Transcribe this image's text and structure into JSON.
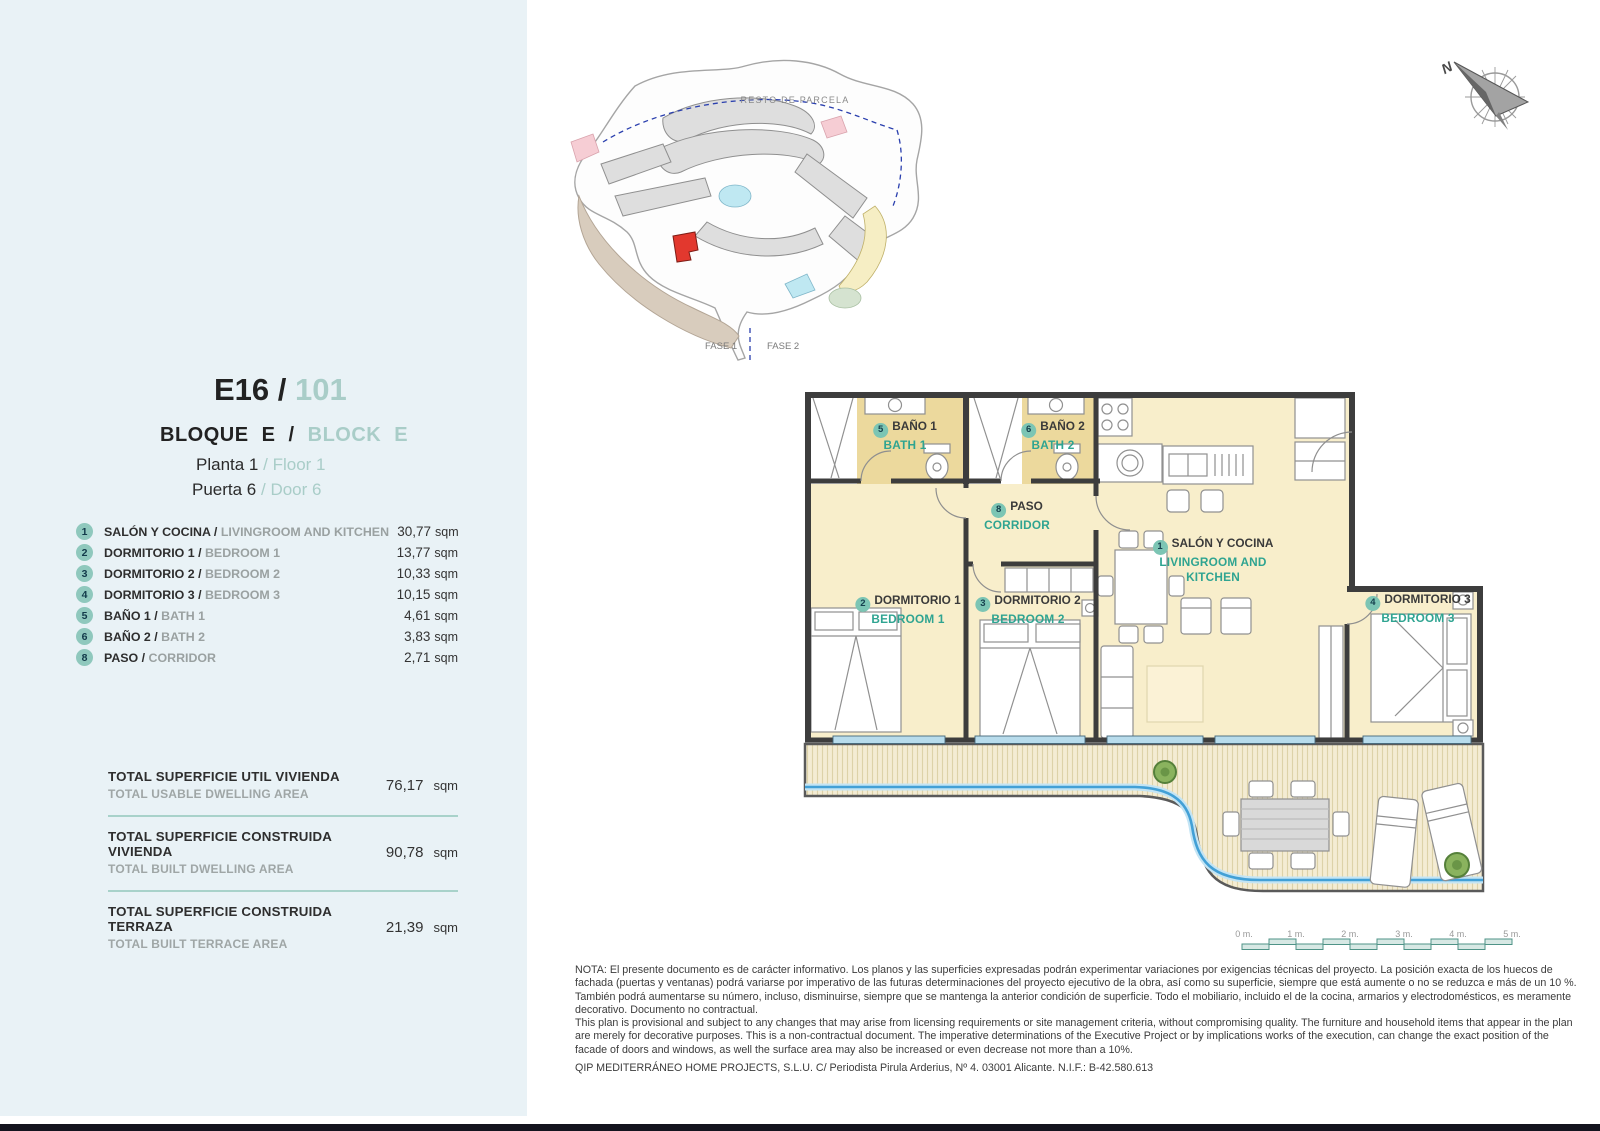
{
  "header": {
    "code": "E16",
    "slash": "/",
    "unit": "101",
    "bloque": "BLOQUE E",
    "block": "BLOCK E",
    "planta_label": "Planta 1",
    "floor_label": "Floor 1",
    "puerta_label": "Puerta 6",
    "door_label": "Door 6"
  },
  "rooms": [
    {
      "num": "1",
      "es": "SALÓN Y COCINA /",
      "en": "LIVINGROOM AND KITCHEN",
      "area": "30,77",
      "unit": "sqm"
    },
    {
      "num": "2",
      "es": "DORMITORIO 1 /",
      "en": "BEDROOM 1",
      "area": "13,77",
      "unit": "sqm"
    },
    {
      "num": "3",
      "es": "DORMITORIO 2 /",
      "en": "BEDROOM 2",
      "area": "10,33",
      "unit": "sqm"
    },
    {
      "num": "4",
      "es": "DORMITORIO 3 /",
      "en": "BEDROOM 3",
      "area": "10,15",
      "unit": "sqm"
    },
    {
      "num": "5",
      "es": "BAÑO 1 /",
      "en": "BATH 1",
      "area": "4,61",
      "unit": "sqm"
    },
    {
      "num": "6",
      "es": "BAÑO 2 /",
      "en": "BATH 2",
      "area": "3,83",
      "unit": "sqm"
    },
    {
      "num": "8",
      "es": "PASO /",
      "en": "CORRIDOR",
      "area": "2,71",
      "unit": "sqm"
    }
  ],
  "totals": [
    {
      "es": "TOTAL SUPERFICIE UTIL VIVIENDA",
      "en": "TOTAL USABLE DWELLING AREA",
      "value": "76,17",
      "unit": "sqm"
    },
    {
      "es": "TOTAL SUPERFICIE CONSTRUIDA VIVIENDA",
      "en": "TOTAL BUILT DWELLING AREA",
      "value": "90,78",
      "unit": "sqm"
    },
    {
      "es": "TOTAL SUPERFICIE CONSTRUIDA TERRAZA",
      "en": "TOTAL BUILT TERRACE AREA",
      "value": "21,39",
      "unit": "sqm"
    }
  ],
  "plan_labels": {
    "bath1": {
      "num": "5",
      "es": "BAÑO 1",
      "en": "BATH 1"
    },
    "bath2": {
      "num": "6",
      "es": "BAÑO 2",
      "en": "BATH 2"
    },
    "paso": {
      "num": "8",
      "es": "PASO",
      "en": "CORRIDOR"
    },
    "salon": {
      "num": "1",
      "es": "SALÓN Y COCINA",
      "en": "LIVINGROOM AND KITCHEN"
    },
    "bed1": {
      "num": "2",
      "es": "DORMITORIO 1",
      "en": "BEDROOM 1"
    },
    "bed2": {
      "num": "3",
      "es": "DORMITORIO 2",
      "en": "BEDROOM 2"
    },
    "bed3": {
      "num": "4",
      "es": "DORMITORIO 3",
      "en": "BEDROOM 3"
    }
  },
  "site_plan": {
    "resto": "RESTO DE PARCELA",
    "fase1": "FASE 1",
    "fase2": "FASE 2"
  },
  "compass": {
    "north": "N"
  },
  "scale_bar": {
    "labels": [
      "0 m.",
      "1 m.",
      "2 m.",
      "3 m.",
      "4 m.",
      "5 m."
    ]
  },
  "notes": {
    "es": "NOTA: El presente documento es de carácter informativo. Los planos y las superficies expresadas podrán experimentar variaciones por exigencias técnicas del proyecto. La posición exacta de los huecos de fachada (puertas y ventanas) podrá variarse por imperativo de las futuras determinaciones del proyecto ejecutivo de la obra, así como su superficie, siempre que está aumente o no se reduzca e más de un 10 %. También podrá aumentarse su número, incluso, disminuirse, siempre que se mantenga la anterior condición de superficie. Todo el mobiliario, incluido el de la cocina, armarios y electrodomésticos, es meramente decorativo. Documento no contractual.",
    "en": "This plan is provisional and subject to any changes that may arise from licensing requirements or site management criteria, without compromising quality. The furniture and household items that appear in the plan are merely for decorative purposes. This is a non-contractual document. The imperative determinations of the Executive Project or by implications works of the execution, can change the exact position of the facade of doors and windows, as well the surface area may also be increased or even decrease not more than a 10%.",
    "company": "QIP MEDITERRÁNEO HOME PROJECTS, S.L.U. C/ Periodista Pirula Arderius, Nº 4. 03001 Alicante. N.I.F.: B-42.580.613"
  },
  "colors": {
    "accent_teal": "#2fa491",
    "badge": "#8fc8bd",
    "panel_bg": "#e9f2f6",
    "room_cream": "#f8eecb",
    "bath_tan": "#ecd99d",
    "highlight_red": "#e2382e",
    "window_blue": "#b8dcec",
    "pool_blue": "#42a0d6"
  }
}
